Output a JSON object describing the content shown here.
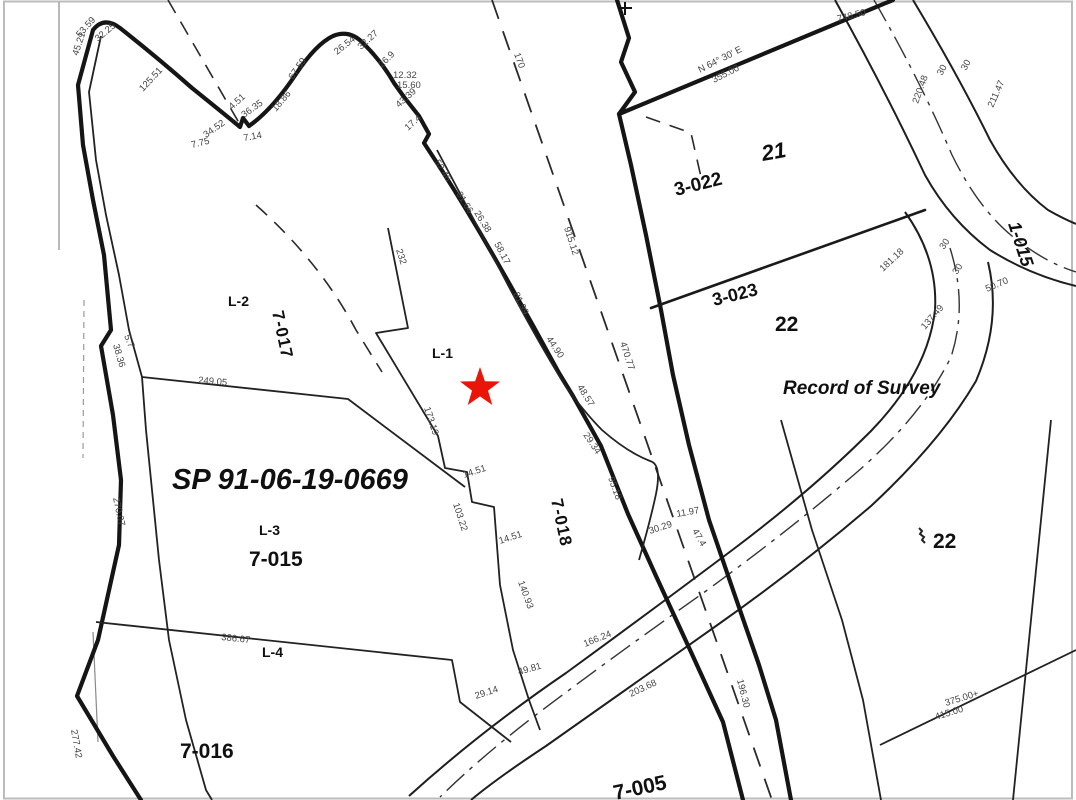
{
  "map": {
    "description": "Record of Survey parcel map",
    "background_color": "#ffffff",
    "line_color": "#151515",
    "star_color": "#ea1508",
    "star": {
      "x": 480,
      "y": 388
    },
    "titles": {
      "survey_number": "SP 91-06-19-0669",
      "record_of_survey": "Record of Survey"
    },
    "labels": [
      {
        "t": "SP 91-06-19-0669",
        "x": 172,
        "y": 489,
        "c": "title",
        "n": "survey-number-label"
      },
      {
        "t": "Record of Survey",
        "x": 783,
        "y": 394,
        "c": "ros",
        "n": "record-of-survey-label"
      },
      {
        "t": "L-1",
        "x": 432,
        "y": 358,
        "c": "lot",
        "n": "lot-l1-label"
      },
      {
        "t": "L-2",
        "x": 228,
        "y": 306,
        "c": "lot",
        "n": "lot-l2-label"
      },
      {
        "t": "L-3",
        "x": 259,
        "y": 535,
        "c": "lot",
        "n": "lot-l3-label"
      },
      {
        "t": "L-4",
        "x": 262,
        "y": 657,
        "c": "lot",
        "n": "lot-l4-label"
      },
      {
        "t": "7-017",
        "x": 272,
        "y": 312,
        "r": 78,
        "c": "pid",
        "n": "parcel-7-017-label"
      },
      {
        "t": "7-018",
        "x": 551,
        "y": 500,
        "r": 78,
        "c": "pid",
        "n": "parcel-7-018-label"
      },
      {
        "t": "7-015",
        "x": 249,
        "y": 566,
        "c": "pid-lg",
        "n": "parcel-7-015-label"
      },
      {
        "t": "7-016",
        "x": 180,
        "y": 758,
        "c": "pid-lg",
        "n": "parcel-7-016-label"
      },
      {
        "t": "7-005",
        "x": 615,
        "y": 800,
        "r": -12,
        "c": "pid-lg",
        "n": "parcel-7-005-label"
      },
      {
        "t": "3-022",
        "x": 676,
        "y": 196,
        "r": -14,
        "c": "pid-lg",
        "s": 19,
        "n": "parcel-3-022-label"
      },
      {
        "t": "3-023",
        "x": 714,
        "y": 306,
        "r": -14,
        "c": "pid-lg",
        "s": 18,
        "n": "parcel-3-023-label"
      },
      {
        "t": "21",
        "x": 763,
        "y": 161,
        "r": -10,
        "c": "blk",
        "n": "block-21-label"
      },
      {
        "t": "22",
        "x": 775,
        "y": 331,
        "c": "blk2",
        "n": "block-22-label"
      },
      {
        "t": "22",
        "x": 933,
        "y": 548,
        "c": "blk2",
        "n": "block-22b-label"
      },
      {
        "t": "1-015",
        "x": 1008,
        "y": 224,
        "r": 72,
        "c": "roadlbl",
        "n": "road-1-015-label"
      },
      {
        "t": "45.21",
        "x": 78,
        "y": 56,
        "r": -72,
        "c": "dim"
      },
      {
        "t": "53.59",
        "x": 80,
        "y": 38,
        "r": -48,
        "c": "dim"
      },
      {
        "t": "32.25",
        "x": 98,
        "y": 42,
        "r": -40,
        "c": "dim"
      },
      {
        "t": "125.51",
        "x": 143,
        "y": 92,
        "r": -47,
        "c": "dim"
      },
      {
        "t": "4.51",
        "x": 232,
        "y": 110,
        "r": -42,
        "c": "dim"
      },
      {
        "t": "36.35",
        "x": 244,
        "y": 118,
        "r": -35,
        "c": "dim"
      },
      {
        "t": "34.52",
        "x": 206,
        "y": 138,
        "r": -35,
        "c": "dim"
      },
      {
        "t": "7.75",
        "x": 192,
        "y": 148,
        "r": -14,
        "c": "dim"
      },
      {
        "t": "7.14",
        "x": 244,
        "y": 141,
        "r": -10,
        "c": "dim"
      },
      {
        "t": "18.86",
        "x": 276,
        "y": 112,
        "r": -50,
        "c": "dim"
      },
      {
        "t": "67.59",
        "x": 293,
        "y": 80,
        "r": -55,
        "c": "dim"
      },
      {
        "t": "26.54",
        "x": 337,
        "y": 55,
        "r": -38,
        "c": "dim"
      },
      {
        "t": "32.27",
        "x": 361,
        "y": 50,
        "r": -42,
        "c": "dim"
      },
      {
        "t": "26.9",
        "x": 382,
        "y": 68,
        "r": -45,
        "c": "dim"
      },
      {
        "t": "12.32",
        "x": 393,
        "y": 78,
        "c": "dim"
      },
      {
        "t": "15.60",
        "x": 397,
        "y": 88,
        "c": "dim"
      },
      {
        "t": "43.39",
        "x": 399,
        "y": 108,
        "r": -42,
        "c": "dim"
      },
      {
        "t": "17.4",
        "x": 408,
        "y": 131,
        "r": -42,
        "c": "dim"
      },
      {
        "t": "52.46",
        "x": 434,
        "y": 162,
        "r": 58,
        "c": "dim"
      },
      {
        "t": "31.66",
        "x": 456,
        "y": 194,
        "r": 58,
        "c": "dim"
      },
      {
        "t": "26.38",
        "x": 474,
        "y": 213,
        "r": 58,
        "c": "dim"
      },
      {
        "t": "58.17",
        "x": 494,
        "y": 244,
        "r": 62,
        "c": "dim"
      },
      {
        "t": "232",
        "x": 396,
        "y": 250,
        "r": 72,
        "c": "dim"
      },
      {
        "t": "81.99",
        "x": 513,
        "y": 294,
        "r": 64,
        "c": "dim"
      },
      {
        "t": "44.90",
        "x": 546,
        "y": 339,
        "r": 56,
        "c": "dim"
      },
      {
        "t": "48.57",
        "x": 577,
        "y": 387,
        "r": 58,
        "c": "dim"
      },
      {
        "t": "173.19",
        "x": 424,
        "y": 408,
        "r": 72,
        "c": "dim"
      },
      {
        "t": "103.22",
        "x": 453,
        "y": 504,
        "r": 72,
        "c": "dim"
      },
      {
        "t": "14.51",
        "x": 464,
        "y": 478,
        "r": -18,
        "c": "dim"
      },
      {
        "t": "14.51",
        "x": 500,
        "y": 544,
        "r": -18,
        "c": "dim"
      },
      {
        "t": "140.93",
        "x": 518,
        "y": 582,
        "r": 70,
        "c": "dim"
      },
      {
        "t": "49.81",
        "x": 519,
        "y": 675,
        "r": -16,
        "c": "dim"
      },
      {
        "t": "29.14",
        "x": 476,
        "y": 699,
        "r": -18,
        "c": "dim"
      },
      {
        "t": "95.18",
        "x": 608,
        "y": 478,
        "r": 70,
        "c": "dim"
      },
      {
        "t": "29.34",
        "x": 583,
        "y": 435,
        "r": 56,
        "c": "dim"
      },
      {
        "t": "30.29",
        "x": 650,
        "y": 534,
        "r": -18,
        "c": "dim"
      },
      {
        "t": "11.97",
        "x": 677,
        "y": 517,
        "r": -10,
        "c": "dim"
      },
      {
        "t": "47.4",
        "x": 692,
        "y": 531,
        "r": 60,
        "c": "dim"
      },
      {
        "t": "170",
        "x": 514,
        "y": 54,
        "r": 70,
        "c": "dim"
      },
      {
        "t": "915.12",
        "x": 564,
        "y": 228,
        "r": 72,
        "c": "dim"
      },
      {
        "t": "470.77",
        "x": 620,
        "y": 343,
        "r": 72,
        "c": "dim"
      },
      {
        "t": "196.30",
        "x": 737,
        "y": 680,
        "r": 76,
        "c": "dim"
      },
      {
        "t": "166.24",
        "x": 585,
        "y": 647,
        "r": -22,
        "c": "dim"
      },
      {
        "t": "203.68",
        "x": 631,
        "y": 697,
        "r": -25,
        "c": "dim"
      },
      {
        "t": "249.05",
        "x": 198,
        "y": 383,
        "r": 5,
        "c": "dim"
      },
      {
        "t": "386.67",
        "x": 221,
        "y": 640,
        "r": 6,
        "c": "dim"
      },
      {
        "t": "5.7",
        "x": 124,
        "y": 336,
        "r": 68,
        "c": "dim"
      },
      {
        "t": "38.36",
        "x": 113,
        "y": 345,
        "r": 74,
        "c": "dim"
      },
      {
        "t": "270.07",
        "x": 113,
        "y": 498,
        "r": 78,
        "c": "dim"
      },
      {
        "t": "277.42",
        "x": 71,
        "y": 730,
        "r": 80,
        "c": "dim"
      },
      {
        "t": "748.50",
        "x": 838,
        "y": 22,
        "r": -14,
        "c": "dim"
      },
      {
        "t": "N 64° 30' E",
        "x": 700,
        "y": 73,
        "r": -27,
        "c": "dim"
      },
      {
        "t": "355.00",
        "x": 714,
        "y": 83,
        "r": -27,
        "c": "dim"
      },
      {
        "t": "220.48",
        "x": 918,
        "y": 104,
        "r": -70,
        "c": "dim"
      },
      {
        "t": "211.47",
        "x": 993,
        "y": 108,
        "r": -66,
        "c": "dim"
      },
      {
        "t": "30",
        "x": 942,
        "y": 76,
        "r": -62,
        "c": "dim"
      },
      {
        "t": "30",
        "x": 966,
        "y": 71,
        "r": -62,
        "c": "dim"
      },
      {
        "t": "30",
        "x": 944,
        "y": 250,
        "r": -56,
        "c": "dim"
      },
      {
        "t": "30",
        "x": 957,
        "y": 275,
        "r": -56,
        "c": "dim"
      },
      {
        "t": "181.18",
        "x": 883,
        "y": 272,
        "r": -43,
        "c": "dim"
      },
      {
        "t": "50.70",
        "x": 987,
        "y": 292,
        "r": -23,
        "c": "dim"
      },
      {
        "t": "137.49",
        "x": 925,
        "y": 330,
        "r": -49,
        "c": "dim"
      },
      {
        "t": "375.00+",
        "x": 946,
        "y": 706,
        "r": -17,
        "c": "dim"
      },
      {
        "t": "415.00",
        "x": 936,
        "y": 720,
        "r": -17,
        "c": "dim"
      }
    ]
  }
}
